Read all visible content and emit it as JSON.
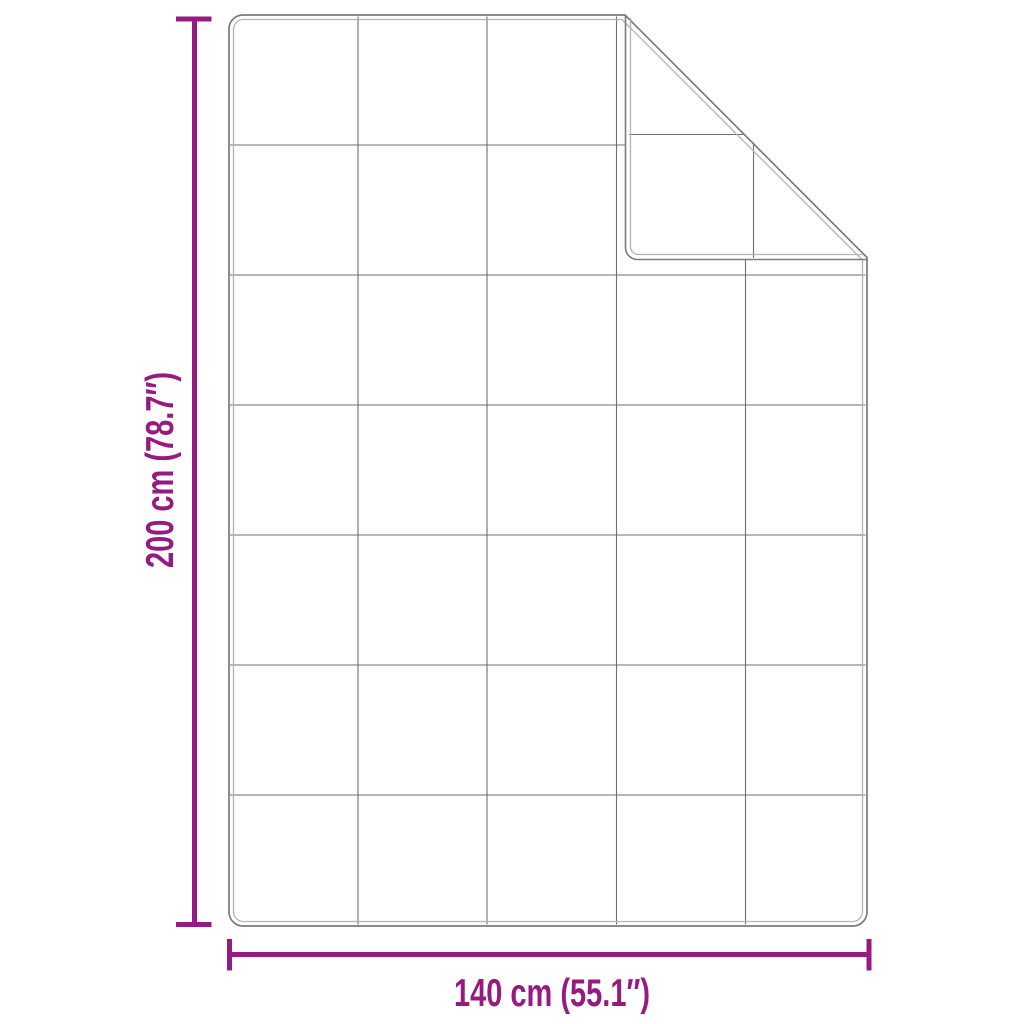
{
  "diagram": {
    "title": "blanket-dimension-diagram",
    "vertical_dimension_label": "200 cm (78.7″)",
    "horizontal_dimension_label": "140 cm (55.1″)",
    "grid_columns": 5,
    "grid_rows": 7,
    "folded_corner": "top-right",
    "colors": {
      "accent": "#951B81",
      "outline_outer": "#7b7b7b",
      "outline_inner": "#b3b3b3",
      "grid_line": "#565656",
      "background": "#ffffff"
    }
  }
}
